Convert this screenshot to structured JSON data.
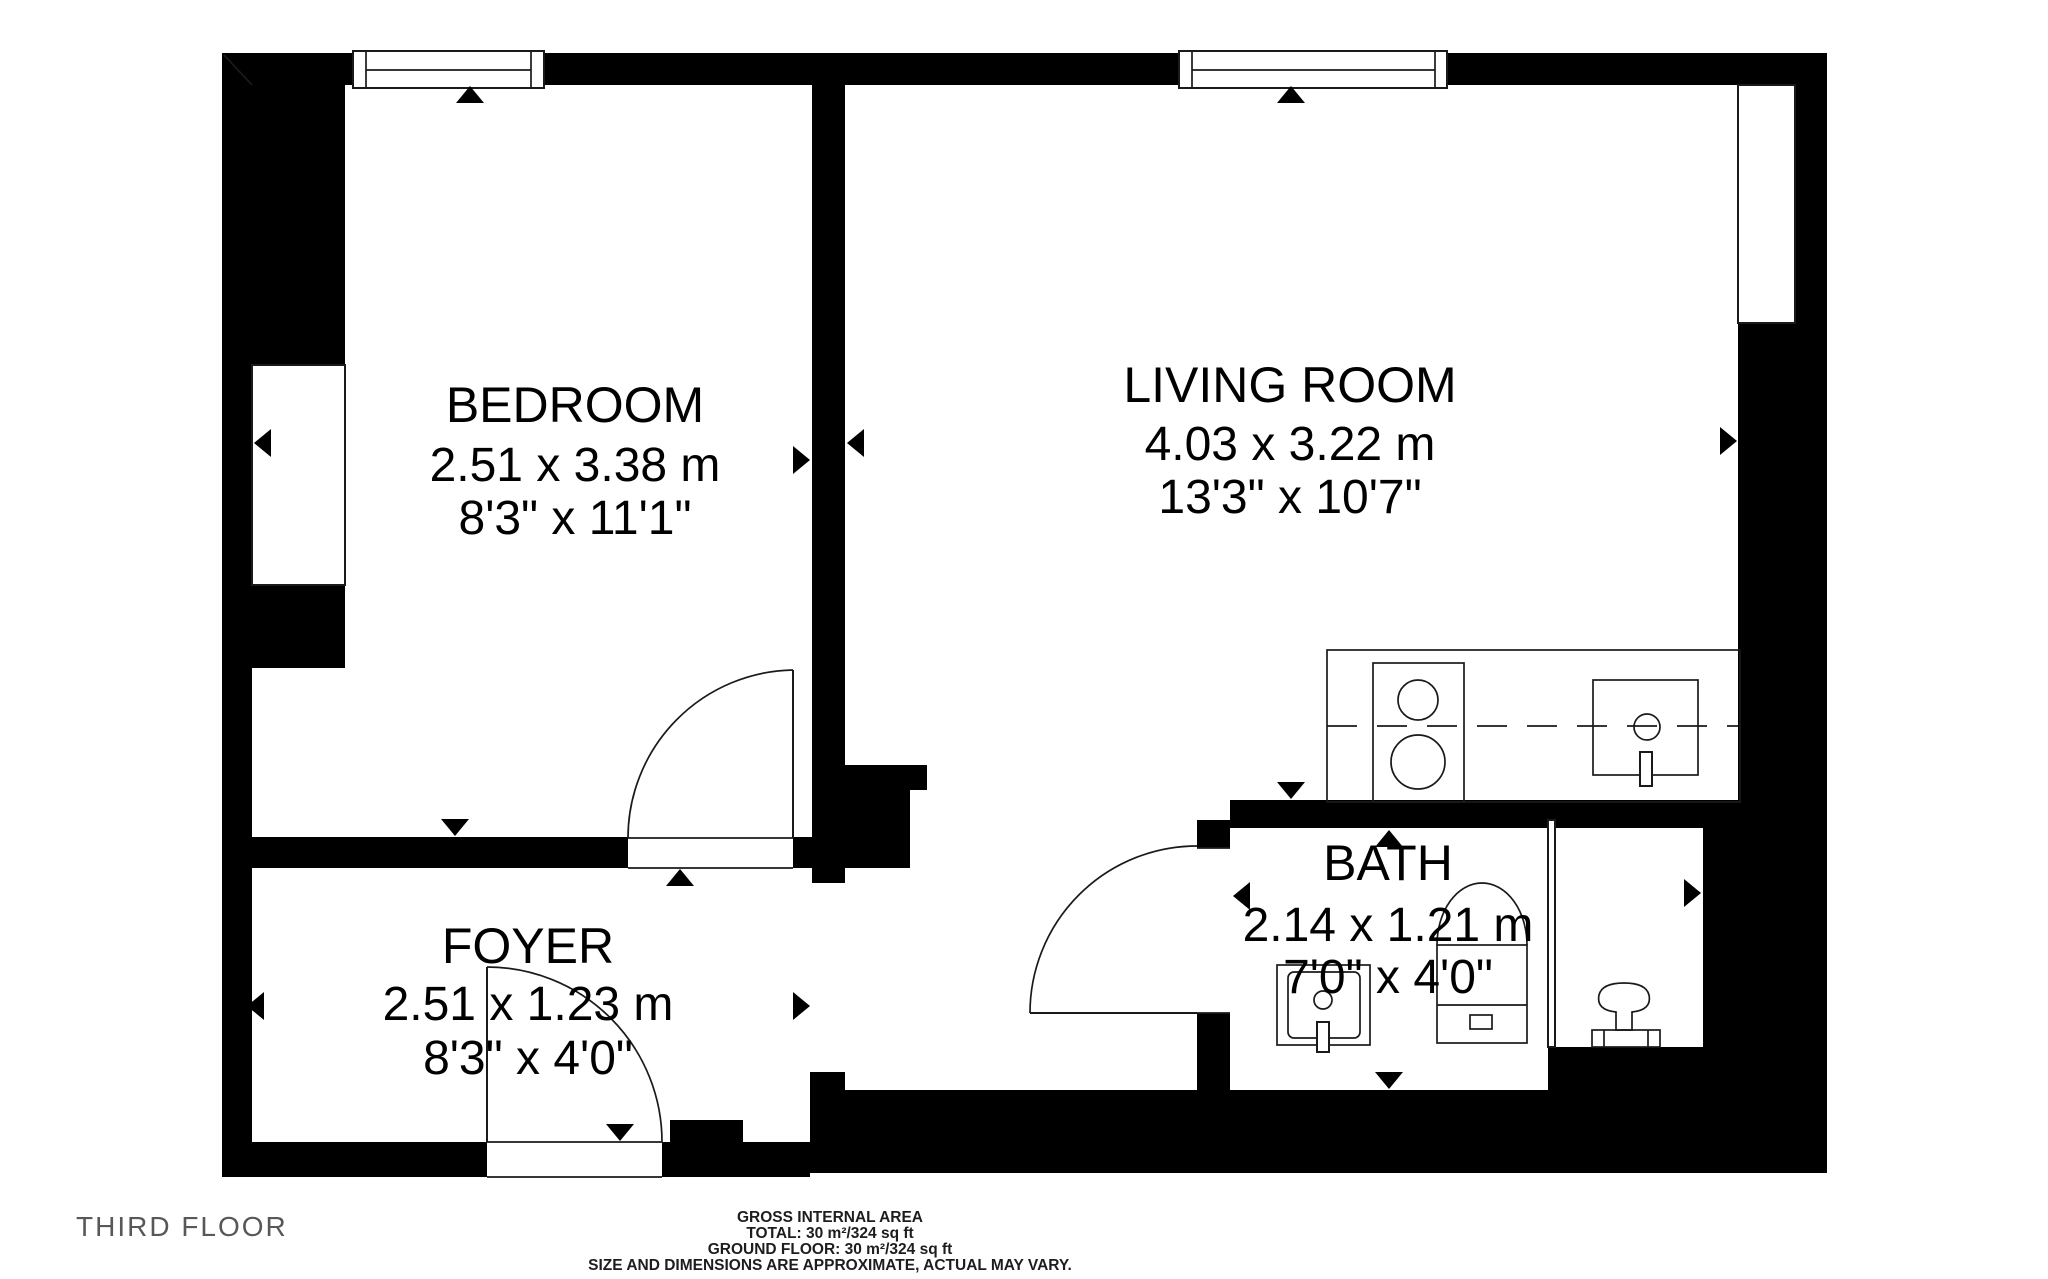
{
  "floor_plan": {
    "floor_label": "THIRD FLOOR",
    "rooms": {
      "bedroom": {
        "name": "BEDROOM",
        "metric": "2.51 x 3.38 m",
        "imperial": "8'3\" x 11'1\""
      },
      "living": {
        "name": "LIVING ROOM",
        "metric": "4.03 x 3.22 m",
        "imperial": "13'3\" x 10'7\""
      },
      "foyer": {
        "name": "FOYER",
        "metric": "2.51 x 1.23 m",
        "imperial": "8'3\" x 4'0\""
      },
      "bath": {
        "name": "BATH",
        "metric": "2.14 x 1.21 m",
        "imperial": "7'0\" x 4'0\""
      }
    },
    "footer": {
      "line1": "GROSS INTERNAL AREA",
      "line2": "TOTAL: 30 m²/324 sq ft",
      "line3": "GROUND FLOOR: 30 m²/324 sq ft",
      "line4": "SIZE AND DIMENSIONS ARE APPROXIMATE, ACTUAL MAY VARY."
    },
    "colors": {
      "wall": "#000000",
      "line": "#1a1a1a",
      "floor_label_text": "#58585b",
      "footer_text": "#1d1d1f",
      "background": "#ffffff"
    }
  }
}
